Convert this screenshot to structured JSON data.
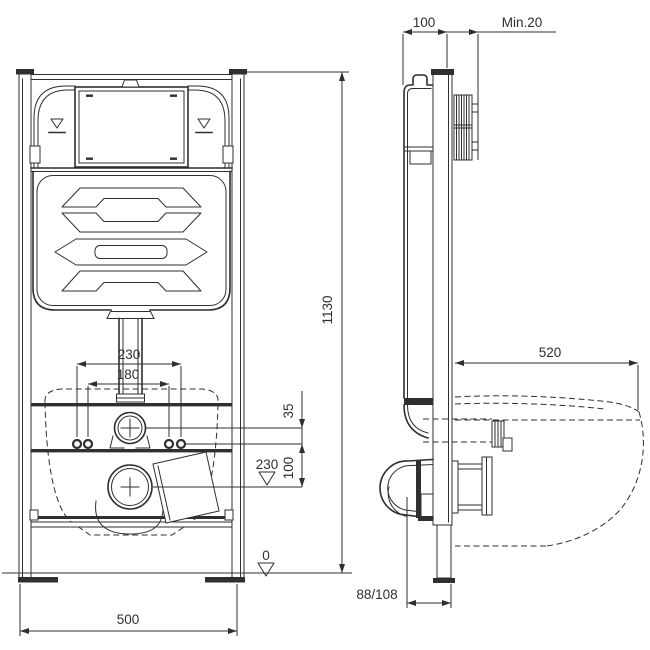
{
  "colors": {
    "line": "#2f2f2f",
    "background": "#ffffff"
  },
  "dims": {
    "front_bolt_outer": "230",
    "front_bolt_inner": "180",
    "front_supply_offset": "35",
    "front_stud_to_drain": "100",
    "front_drain_level": "230",
    "front_floor_level": "0",
    "front_width": "500",
    "front_height": "1130",
    "side_depth": "100",
    "side_min_cover": "Min.20",
    "side_bowl_depth": "520",
    "side_outlet_offset": "88/108"
  }
}
